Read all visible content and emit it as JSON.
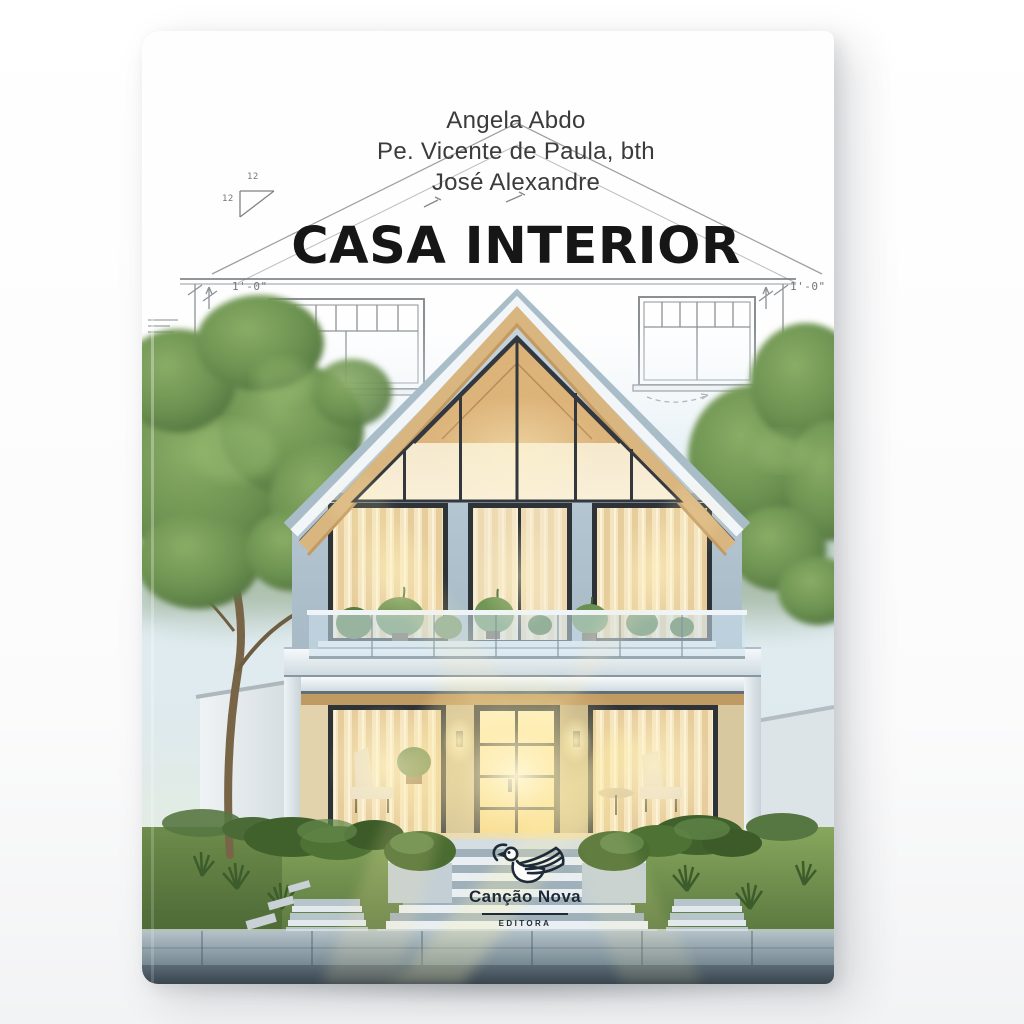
{
  "page": {
    "background": "#fdfdfd"
  },
  "cover": {
    "authors": [
      "Angela Abdo",
      "Pe. Vicente de Paula, bth",
      "José Alexandre"
    ],
    "title": "CASA INTERIOR",
    "publisher": {
      "name": "Canção Nova",
      "imprint": "EDITORA"
    },
    "blueprint_labels": {
      "slope_top": "12",
      "slope_side": "12",
      "dim_left": "1'-0\"",
      "dim_right": "1'-0\""
    },
    "colors": {
      "title": "#161616",
      "authors": "#3b3b3b",
      "logo": "#1e2a37",
      "wall": "#b7cad6",
      "roof_edge": "#a9bdc9",
      "wood_soffit": "#d9b57f",
      "window_glow": "#f8e3a2",
      "lawn": "#6f9149",
      "walkway": "#7b8d99",
      "sky_haze": "#dce9f1"
    }
  }
}
